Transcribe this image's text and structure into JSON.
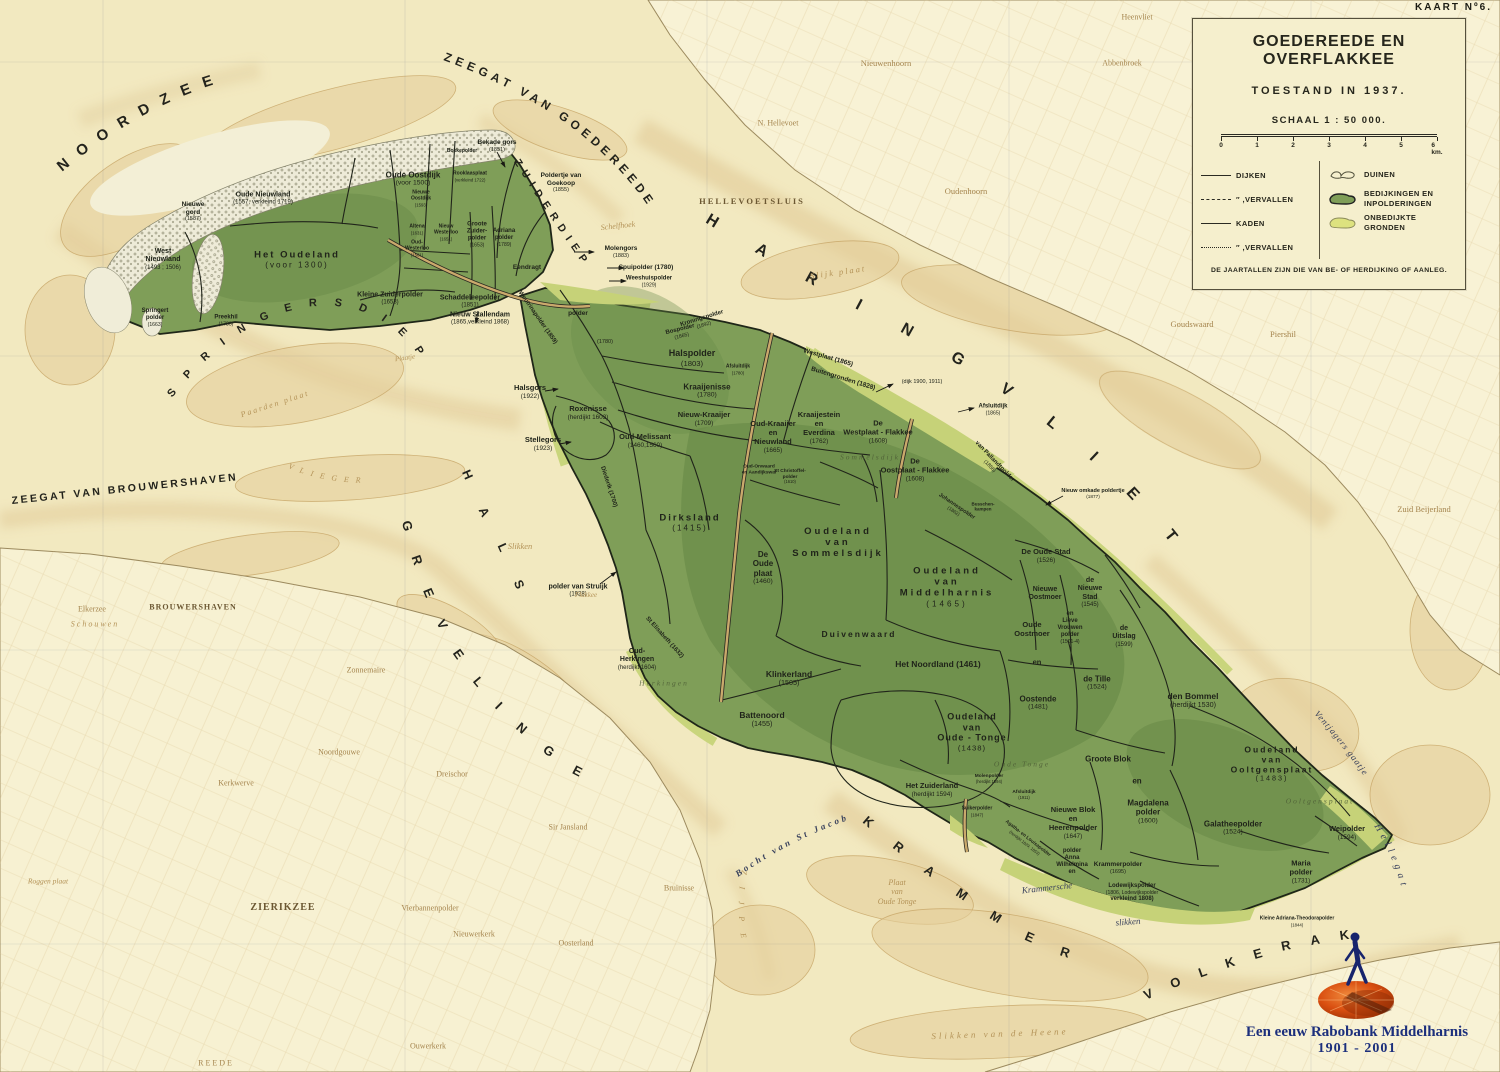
{
  "sheet": {
    "kaart_label": "KAART Nº6."
  },
  "title_box": {
    "title": "GOEDEREEDE EN OVERFLAKKEE",
    "subtitle": "TOESTAND IN 1937.",
    "scale_label": "SCHAAL 1 : 50 000.",
    "scale_ticks": [
      "0",
      "1",
      "2",
      "3",
      "4",
      "5",
      "6 km."
    ],
    "legend_lines": [
      {
        "style": "solid",
        "label": "DIJKEN"
      },
      {
        "style": "dashed",
        "label": "″  ,VERVALLEN"
      },
      {
        "style": "thin",
        "label": "KADEN"
      },
      {
        "style": "dotted",
        "label": "″  ,VERVALLEN"
      }
    ],
    "legend_areas": [
      {
        "type": "duinen",
        "label": "DUINEN"
      },
      {
        "type": "bedijkt",
        "label": "BEDIJKINGEN EN\nINPOLDERINGEN"
      },
      {
        "type": "onbedijkt",
        "label": "ONBEDIJKTE GRONDEN"
      }
    ],
    "note": "DE JAARTALLEN ZIJN DIE VAN BE- OF HERDIJKING OF AANLEG."
  },
  "credit": {
    "line1": "Een eeuw Rabobank Middelharnis",
    "line2": "1901 - 2001"
  },
  "colors": {
    "paper": "#f2e9c0",
    "island_green": "#7f9e58",
    "light_green": "#c6d278",
    "dune": "#eeebd8",
    "sand": "#e4cf9b",
    "ink": "#20241a",
    "credit_blue": "#1c2f7c",
    "rabo_orange": "#d94e10"
  },
  "sea_names": [
    {
      "text": "NOORDZEE"
    },
    {
      "text": "ZEEGAT VAN GOEDEREEDE"
    },
    {
      "text": "ZUIDERDIEP"
    },
    {
      "text": "HARINGVLIET"
    },
    {
      "text": "SPRINGERSDIEP"
    },
    {
      "text": "ZEEGAT VAN BROUWERSHAVEN"
    },
    {
      "text": "GREVELINGEN"
    },
    {
      "text": "HALS"
    },
    {
      "text": "KRAMMER"
    },
    {
      "text": "VOLKERAK"
    },
    {
      "text": "VLIEGER"
    },
    {
      "text": "ZIJPE"
    },
    {
      "text": "Ventjagers gaatje"
    },
    {
      "text": "Hellegat"
    },
    {
      "text": "Bocht van St Jacob"
    }
  ],
  "labels": [
    {
      "t": "Nieuwe\ngord\n(1587)",
      "x": 193,
      "y": 212,
      "s": 6.5
    },
    {
      "t": "Oude Nieuwland\n(1557, verkleind 1719)",
      "x": 263,
      "y": 199,
      "s": 7
    },
    {
      "t": "West\nNieuwland\n(1493 ; 1506)",
      "x": 163,
      "y": 260,
      "s": 7
    },
    {
      "t": "Het Oudeland\n(voor 1300)",
      "x": 297,
      "y": 260,
      "s": 9.5,
      "ls": 2
    },
    {
      "t": "Oude Oostdijk\n(voor 1500)",
      "x": 413,
      "y": 179,
      "s": 8
    },
    {
      "t": "Springert\npolder\n(1663)",
      "x": 155,
      "y": 318,
      "s": 6
    },
    {
      "t": "Preekhil\n(1783)",
      "x": 226,
      "y": 321,
      "s": 6
    },
    {
      "t": "Kleine Zuiderpolder\n(1653)",
      "x": 390,
      "y": 299,
      "s": 7
    },
    {
      "t": "Schaddeleepolder\n(1851)",
      "x": 470,
      "y": 302,
      "s": 7
    },
    {
      "t": "Nieuw Stallendam\n(1865,verkleind 1868)",
      "x": 480,
      "y": 319,
      "s": 7
    },
    {
      "t": "Bekade gors\n(1851)",
      "x": 497,
      "y": 146,
      "s": 6.5
    },
    {
      "t": "Bokkepolder",
      "x": 462,
      "y": 152,
      "s": 5
    },
    {
      "t": "Rooklaasplaat\n(verkleind 1722)",
      "x": 470,
      "y": 177,
      "s": 5
    },
    {
      "t": "Poldertje van\nGoekoop\n(1855)",
      "x": 561,
      "y": 183,
      "s": 6.5
    },
    {
      "t": "Nieuwe\nOostdijk\n(1593)",
      "x": 421,
      "y": 199,
      "s": 5
    },
    {
      "t": "Altena\n(1631)",
      "x": 417,
      "y": 230,
      "s": 5
    },
    {
      "t": "Oud-\nWesterloo\n(1581)",
      "x": 417,
      "y": 249,
      "s": 5
    },
    {
      "t": "Nieuw\nWesterloo\n(1651)",
      "x": 446,
      "y": 233,
      "s": 5
    },
    {
      "t": "Groote\nZuider-\npolder\n(1653)",
      "x": 477,
      "y": 235,
      "s": 6
    },
    {
      "t": "Adriana\npolder\n(1789)",
      "x": 504,
      "y": 238,
      "s": 6
    },
    {
      "t": "Eendragt",
      "x": 527,
      "y": 268,
      "s": 6.5
    },
    {
      "t": "Molengors\n(1883)",
      "x": 621,
      "y": 252,
      "s": 6.5
    },
    {
      "t": "Spuipolder (1780)",
      "x": 646,
      "y": 268,
      "s": 6.5
    },
    {
      "t": "Weeshuispolder\n(1929)",
      "x": 649,
      "y": 282,
      "s": 6
    },
    {
      "t": "Woutrinapolder (1859)",
      "x": 537,
      "y": 318,
      "s": 6,
      "r": 55
    },
    {
      "t": "polder",
      "x": 578,
      "y": 314,
      "s": 6.5
    },
    {
      "t": "(1780)",
      "x": 605,
      "y": 342,
      "s": 6.5
    },
    {
      "t": "Kroningspolder\n(1892)",
      "x": 703,
      "y": 322,
      "s": 6,
      "r": -17
    },
    {
      "t": "Bospolder\n(1865)",
      "x": 681,
      "y": 333,
      "s": 6,
      "r": -14
    },
    {
      "t": "Halspolder\n(1803)",
      "x": 692,
      "y": 358,
      "s": 9
    },
    {
      "t": "Afsluitdijk\n(1780)",
      "x": 738,
      "y": 370,
      "s": 5
    },
    {
      "t": "Kraaijenisse\n(1780)",
      "x": 707,
      "y": 391,
      "s": 8
    },
    {
      "t": "Nieuw-Kraaijer\n(1709)",
      "x": 704,
      "y": 419,
      "s": 7.5
    },
    {
      "t": "Oud-Kraaijer\nen\nNieuwland\n(1665)",
      "x": 773,
      "y": 437,
      "s": 7.5
    },
    {
      "t": "Kraaijestein\nen\nEverdina\n(1762)",
      "x": 819,
      "y": 428,
      "s": 7.5
    },
    {
      "t": "De\nWestplaat - Flakkee\n(1608)",
      "x": 878,
      "y": 432,
      "s": 7.5
    },
    {
      "t": "Westplaat (1865)",
      "x": 828,
      "y": 358,
      "s": 6.5,
      "r": 16
    },
    {
      "t": "Buitengronden (1828)",
      "x": 843,
      "y": 379,
      "s": 6.5,
      "r": 17
    },
    {
      "t": "(dijk 1900, 1911)",
      "x": 922,
      "y": 382,
      "s": 6.5
    },
    {
      "t": "Afsluitdijk\n(1865)",
      "x": 993,
      "y": 410,
      "s": 6
    },
    {
      "t": "Roxenisse\n(herdijkt 1603)",
      "x": 588,
      "y": 413,
      "s": 7.5
    },
    {
      "t": "Halsgors\n(1922)",
      "x": 530,
      "y": 392,
      "s": 7.5
    },
    {
      "t": "Stellegors\n(1923)",
      "x": 543,
      "y": 444,
      "s": 7.5
    },
    {
      "t": "Oud-Melissant\n(1460,1560)",
      "x": 645,
      "y": 441,
      "s": 7.5
    },
    {
      "t": "Diederik (1700)",
      "x": 608,
      "y": 487,
      "s": 6,
      "r": 72
    },
    {
      "t": "Dirksland\n(1415)",
      "x": 690,
      "y": 523,
      "s": 9.5,
      "ls": 2
    },
    {
      "t": "De\nOude\nplaat\n(1460)",
      "x": 763,
      "y": 568,
      "s": 8
    },
    {
      "t": "St Elisabeth (1632)",
      "x": 664,
      "y": 638,
      "s": 6,
      "r": 48
    },
    {
      "t": "Oud-\nHerkingen\n(herdijkt 1604)",
      "x": 637,
      "y": 660,
      "s": 7
    },
    {
      "t": "polder van Struijk\n(1928)",
      "x": 578,
      "y": 591,
      "s": 7
    },
    {
      "t": "Oudeland\nvan\nSommelsdijk",
      "x": 838,
      "y": 543,
      "s": 9.5,
      "ls": 3
    },
    {
      "t": "Oudeland\nvan\nMiddelharnis\n(1465)",
      "x": 947,
      "y": 587,
      "s": 9.5,
      "ls": 3
    },
    {
      "t": "Duivenwaard",
      "x": 859,
      "y": 634,
      "s": 8.5,
      "ls": 2
    },
    {
      "t": "Klinkerland\n(1505)",
      "x": 789,
      "y": 678,
      "s": 8.5
    },
    {
      "t": "Het Noordland  (1461)",
      "x": 938,
      "y": 664,
      "s": 8.5
    },
    {
      "t": "Battenoord\n(1455)",
      "x": 762,
      "y": 719,
      "s": 8.5
    },
    {
      "t": "Oudeland\nvan\nOude - Tonge\n(1438)",
      "x": 972,
      "y": 732,
      "s": 9,
      "ls": 1
    },
    {
      "t": "Oostende\n(1481)",
      "x": 1038,
      "y": 703,
      "s": 8
    },
    {
      "t": "de  Tille\n(1524)",
      "x": 1097,
      "y": 683,
      "s": 8
    },
    {
      "t": "Oude\nOostmoer",
      "x": 1032,
      "y": 630,
      "s": 7.5
    },
    {
      "t": "en",
      "x": 1037,
      "y": 663,
      "s": 7.5
    },
    {
      "t": "Nieuwe\nOostmoer",
      "x": 1045,
      "y": 594,
      "s": 7
    },
    {
      "t": "en\nLieve\nVrouwen\npolder\n(1501-4)",
      "x": 1070,
      "y": 628,
      "s": 6
    },
    {
      "t": "De  Oude Stad\n(1526)",
      "x": 1046,
      "y": 556,
      "s": 7.5
    },
    {
      "t": "de\nNieuwe\nStad\n(1545)",
      "x": 1090,
      "y": 593,
      "s": 7
    },
    {
      "t": "de\nUitslag\n(1599)",
      "x": 1124,
      "y": 637,
      "s": 7
    },
    {
      "t": "den  Bommel\n(herdijkt 1530)",
      "x": 1193,
      "y": 700,
      "s": 8.5
    },
    {
      "t": "Johannespolder\n(1862)",
      "x": 955,
      "y": 509,
      "s": 5.5,
      "r": 34
    },
    {
      "t": "van Pallandtpolder\n(1856)",
      "x": 992,
      "y": 464,
      "s": 6,
      "r": 46
    },
    {
      "t": "De\nOostplaat - Flakkee\n(1608)",
      "x": 915,
      "y": 470,
      "s": 7.5
    },
    {
      "t": "Nieuw omkade poldertje\n(1877)",
      "x": 1093,
      "y": 494,
      "s": 5.5
    },
    {
      "t": "Het Zuiderland\n(herdijkt 1594)",
      "x": 932,
      "y": 790,
      "s": 7.5
    },
    {
      "t": "Molenpolder\n(herdijkt 1594)",
      "x": 989,
      "y": 779,
      "s": 4.8
    },
    {
      "t": "Suikerpolder\n(1847)",
      "x": 977,
      "y": 812,
      "s": 5
    },
    {
      "t": "Afsluitdijk\n(1911)",
      "x": 1024,
      "y": 795,
      "s": 4.8
    },
    {
      "t": "Nieuwe Blok\nen\nHeerenpolder\n(1647)",
      "x": 1073,
      "y": 823,
      "s": 7.5
    },
    {
      "t": "Groote  Blok",
      "x": 1108,
      "y": 759,
      "s": 8
    },
    {
      "t": "en",
      "x": 1137,
      "y": 781,
      "s": 8
    },
    {
      "t": "Magdalena\npolder\n(1600)",
      "x": 1148,
      "y": 812,
      "s": 8
    },
    {
      "t": "polder\nAnna\nWilhelmina\nen",
      "x": 1072,
      "y": 862,
      "s": 6
    },
    {
      "t": "Krammerpolder\n(1695)",
      "x": 1118,
      "y": 868,
      "s": 6.5
    },
    {
      "t": "Lodewijkspolder\n(1806, Lodewijkspolder\nverkleind 1808)",
      "x": 1132,
      "y": 893,
      "s": 6
    },
    {
      "t": "Agatha- en Louisapolder\n(herdijkt 1829, 1853)",
      "x": 1026,
      "y": 841,
      "s": 4.8,
      "r": 38
    },
    {
      "t": "Galatheepolder\n(1524)",
      "x": 1233,
      "y": 828,
      "s": 8
    },
    {
      "t": "Oudeland\nvan\nOoltgensplaat\n(1483)",
      "x": 1272,
      "y": 764,
      "s": 8.5,
      "ls": 2
    },
    {
      "t": "Weipolder\n(1594)",
      "x": 1347,
      "y": 833,
      "s": 7.5
    },
    {
      "t": "Maria\npolder\n(1731)",
      "x": 1301,
      "y": 872,
      "s": 7.5
    },
    {
      "t": "Kleine  Adriana-Theodorapolder\n(1844)",
      "x": 1297,
      "y": 922,
      "s": 5
    },
    {
      "t": "Oud-Onwaard\nen Aandijkswal",
      "x": 759,
      "y": 470,
      "s": 4.8
    },
    {
      "t": "St Christoffel-\npolder\n(1610)",
      "x": 790,
      "y": 477,
      "s": 4.8
    },
    {
      "t": "Busschen-\nkampen",
      "x": 983,
      "y": 507,
      "s": 4.5
    },
    {
      "t": "Krammersche",
      "x": 1047,
      "y": 888,
      "s": 9,
      "r": -6,
      "c": "water-it"
    },
    {
      "t": "slikken",
      "x": 1128,
      "y": 922,
      "s": 9,
      "r": -4,
      "c": "water-it"
    },
    {
      "t": "Slikken  van  de  Heene",
      "x": 1000,
      "y": 1034,
      "s": 9,
      "r": -2,
      "c": "flat",
      "ls": 3
    },
    {
      "t": "Plaat\nvan\nOude Tonge",
      "x": 897,
      "y": 892,
      "s": 8,
      "c": "flat"
    },
    {
      "t": "Roggen plaat",
      "x": 48,
      "y": 882,
      "s": 7.5,
      "c": "flat"
    },
    {
      "t": "Paarden plaat",
      "x": 275,
      "y": 404,
      "s": 8,
      "r": -18,
      "c": "flat",
      "ls": 2
    },
    {
      "t": "Slijk plaat",
      "x": 838,
      "y": 272,
      "s": 8.5,
      "r": -8,
      "c": "flat",
      "ls": 2
    },
    {
      "t": "Plaatje",
      "x": 405,
      "y": 358,
      "s": 7,
      "r": -8,
      "c": "flat"
    },
    {
      "t": "Schelfhoek",
      "x": 618,
      "y": 226,
      "s": 8,
      "r": -6,
      "c": "flat"
    },
    {
      "t": "Slikken",
      "x": 520,
      "y": 546,
      "s": 8.5,
      "c": "flat"
    },
    {
      "t": "Flakkee",
      "x": 586,
      "y": 595,
      "s": 7,
      "c": "flat"
    },
    {
      "t": "Sommelsdijk",
      "x": 870,
      "y": 458,
      "s": 7.5,
      "c": "ghost"
    },
    {
      "t": "Ooltgensplaat",
      "x": 1320,
      "y": 802,
      "s": 7.5,
      "c": "ghost"
    },
    {
      "t": "Oude Tonge",
      "x": 1022,
      "y": 765,
      "s": 7.5,
      "c": "ghost"
    },
    {
      "t": "Herkingen",
      "x": 664,
      "y": 684,
      "s": 7.5,
      "c": "ghost"
    },
    {
      "t": "HELLEVOETSLUIS",
      "x": 752,
      "y": 201,
      "s": 8.5,
      "c": "townDark",
      "ls": 2
    },
    {
      "t": "Nieuwenhoorn",
      "x": 886,
      "y": 63,
      "s": 8.5,
      "c": "town"
    },
    {
      "t": "N. Hellevoet",
      "x": 778,
      "y": 123,
      "s": 8,
      "c": "town"
    },
    {
      "t": "Oudenhoorn",
      "x": 966,
      "y": 191,
      "s": 8.5,
      "c": "town"
    },
    {
      "t": "Abbenbroek",
      "x": 1122,
      "y": 63,
      "s": 8,
      "c": "town"
    },
    {
      "t": "Heenvliet",
      "x": 1137,
      "y": 17,
      "s": 8,
      "c": "town"
    },
    {
      "t": "Goudswaard",
      "x": 1192,
      "y": 324,
      "s": 8.5,
      "c": "town"
    },
    {
      "t": "Piershil",
      "x": 1283,
      "y": 334,
      "s": 8.5,
      "c": "town"
    },
    {
      "t": "Zuid Beijerland",
      "x": 1424,
      "y": 509,
      "s": 8.5,
      "c": "town"
    },
    {
      "t": "BROUWERSHAVEN",
      "x": 193,
      "y": 607,
      "s": 8,
      "c": "townDark",
      "ls": 1
    },
    {
      "t": "Elkerzee",
      "x": 92,
      "y": 609,
      "s": 8,
      "c": "town"
    },
    {
      "t": "Schouwen",
      "x": 95,
      "y": 624,
      "s": 8,
      "c": "flat",
      "ls": 2
    },
    {
      "t": "Zonnemaire",
      "x": 366,
      "y": 670,
      "s": 8,
      "c": "town"
    },
    {
      "t": "ZIERIKZEE",
      "x": 283,
      "y": 908,
      "s": 10,
      "c": "townDark",
      "ls": 1
    },
    {
      "t": "Kerkwerve",
      "x": 236,
      "y": 783,
      "s": 8,
      "c": "town"
    },
    {
      "t": "Noordgouwe",
      "x": 339,
      "y": 752,
      "s": 8,
      "c": "town"
    },
    {
      "t": "Dreischor",
      "x": 452,
      "y": 774,
      "s": 8,
      "c": "town"
    },
    {
      "t": "Vierbannenpolder",
      "x": 430,
      "y": 908,
      "s": 8,
      "c": "town"
    },
    {
      "t": "Nieuwerkerk",
      "x": 474,
      "y": 934,
      "s": 8,
      "c": "town"
    },
    {
      "t": "Oosterland",
      "x": 576,
      "y": 943,
      "s": 8,
      "c": "town"
    },
    {
      "t": "Bruinisse",
      "x": 679,
      "y": 888,
      "s": 8,
      "c": "town"
    },
    {
      "t": "Sir Jansland",
      "x": 568,
      "y": 827,
      "s": 8,
      "c": "town"
    },
    {
      "t": "Ouwerkerk",
      "x": 428,
      "y": 1046,
      "s": 8,
      "c": "town"
    },
    {
      "t": "R E E D E",
      "x": 215,
      "y": 1063,
      "s": 8,
      "c": "town"
    }
  ]
}
